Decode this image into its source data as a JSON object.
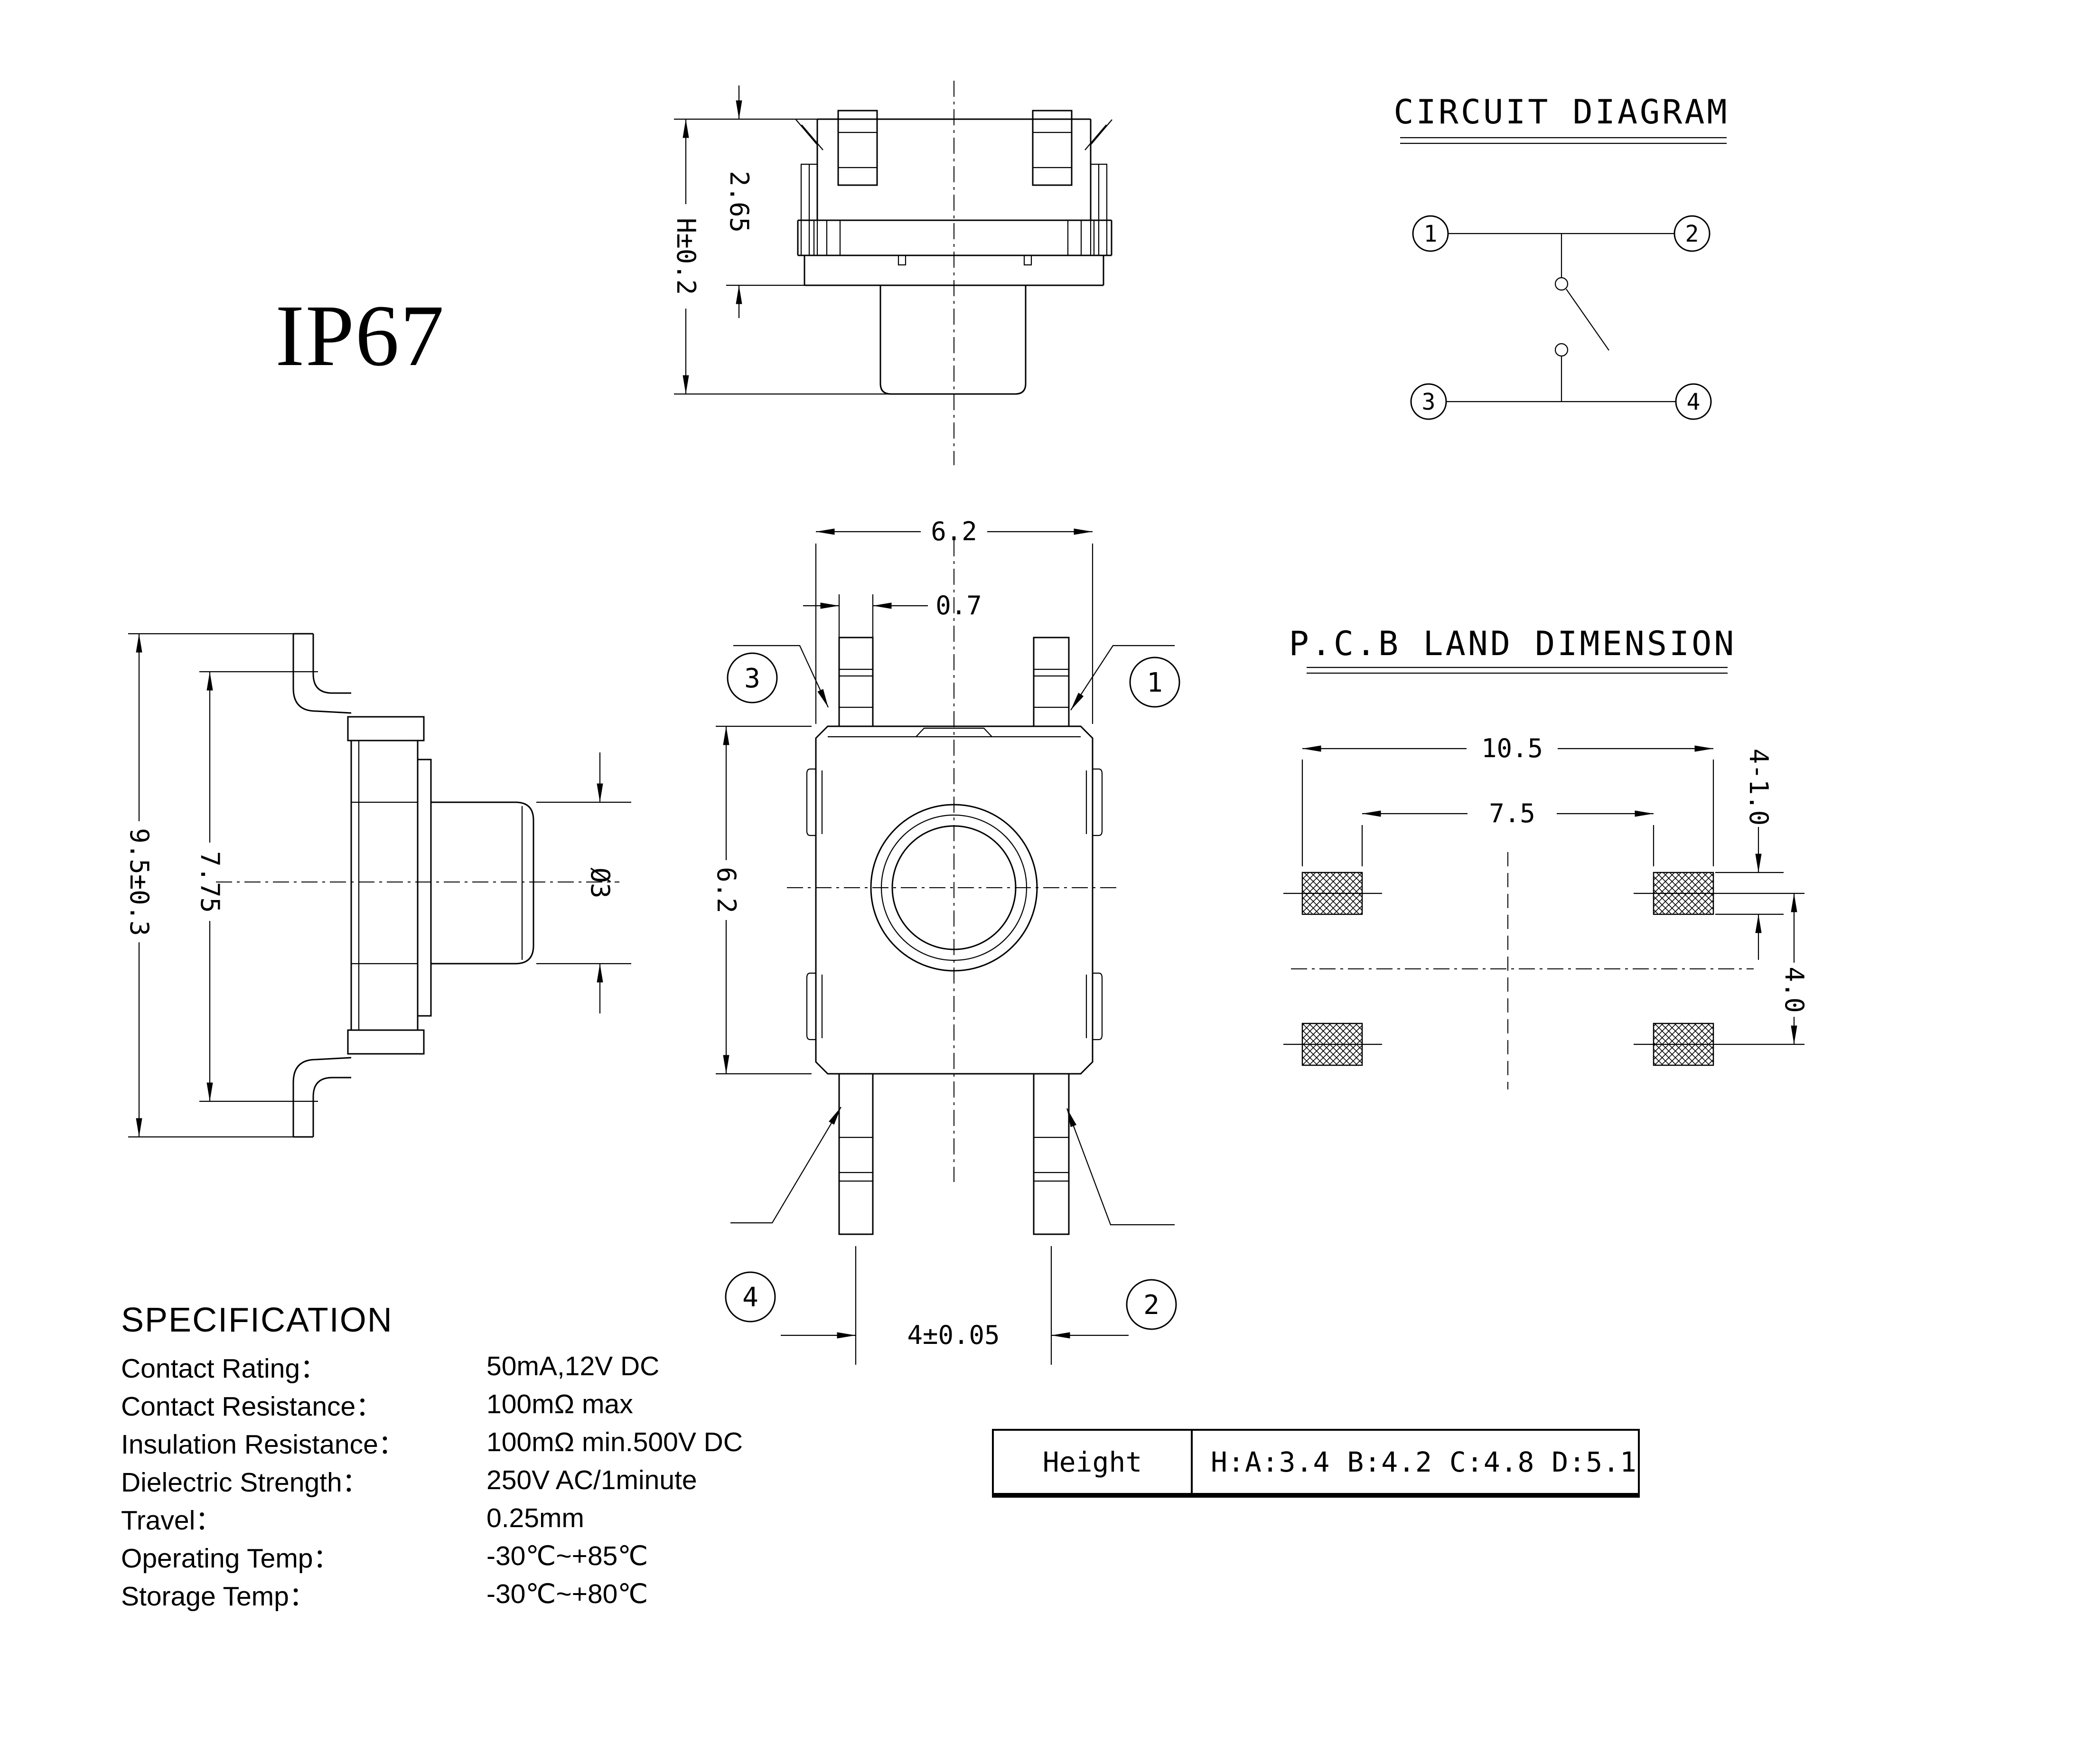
{
  "page": {
    "background": "#ffffff",
    "line_color": "#000000"
  },
  "labels": {
    "ip_rating": "IP67"
  },
  "front_view": {
    "dim_upper_height": "2.65",
    "dim_total_height": "H±0.2"
  },
  "circuit_diagram": {
    "title": "CIRCUIT DIAGRAM",
    "pins": [
      "1",
      "2",
      "3",
      "4"
    ]
  },
  "side_view": {
    "dim_overall": "9.5±0.3",
    "dim_body": "7.75",
    "dim_stem_diameter": "Ø3"
  },
  "top_view": {
    "dim_width": "6.2",
    "dim_pin_width": "0.7",
    "dim_height": "6.2",
    "dim_pin_pitch": "4±0.05",
    "callout_top_left": "3",
    "callout_top_right": "1",
    "callout_bottom_left": "4",
    "callout_bottom_right": "2"
  },
  "pcb_land": {
    "title": "P.C.B LAND DIMENSION",
    "dim_outer_span": "10.5",
    "dim_inner_span": "7.5",
    "dim_pad_size": "4-1.0",
    "dim_row_pitch": "4.0"
  },
  "specification": {
    "heading": "SPECIFICATION",
    "rows": [
      {
        "label": "Contact  Rating：",
        "value": "50mA,12V DC"
      },
      {
        "label": "Contact  Resistance：",
        "value": "100mΩ max"
      },
      {
        "label": "Insulation Resistance：",
        "value": "100mΩ min.500V DC"
      },
      {
        "label": "Dielectric  Strength：",
        "value": "250V AC/1minute"
      },
      {
        "label": "Travel：",
        "value": "0.25mm"
      },
      {
        "label": "Operating Temp：",
        "value": "-30℃~+85℃"
      },
      {
        "label": "Storage Temp：",
        "value": "-30℃~+80℃"
      }
    ]
  },
  "height_table": {
    "label": "Height",
    "value": "H:A:3.4 B:4.2 C:4.8 D:5.1"
  }
}
